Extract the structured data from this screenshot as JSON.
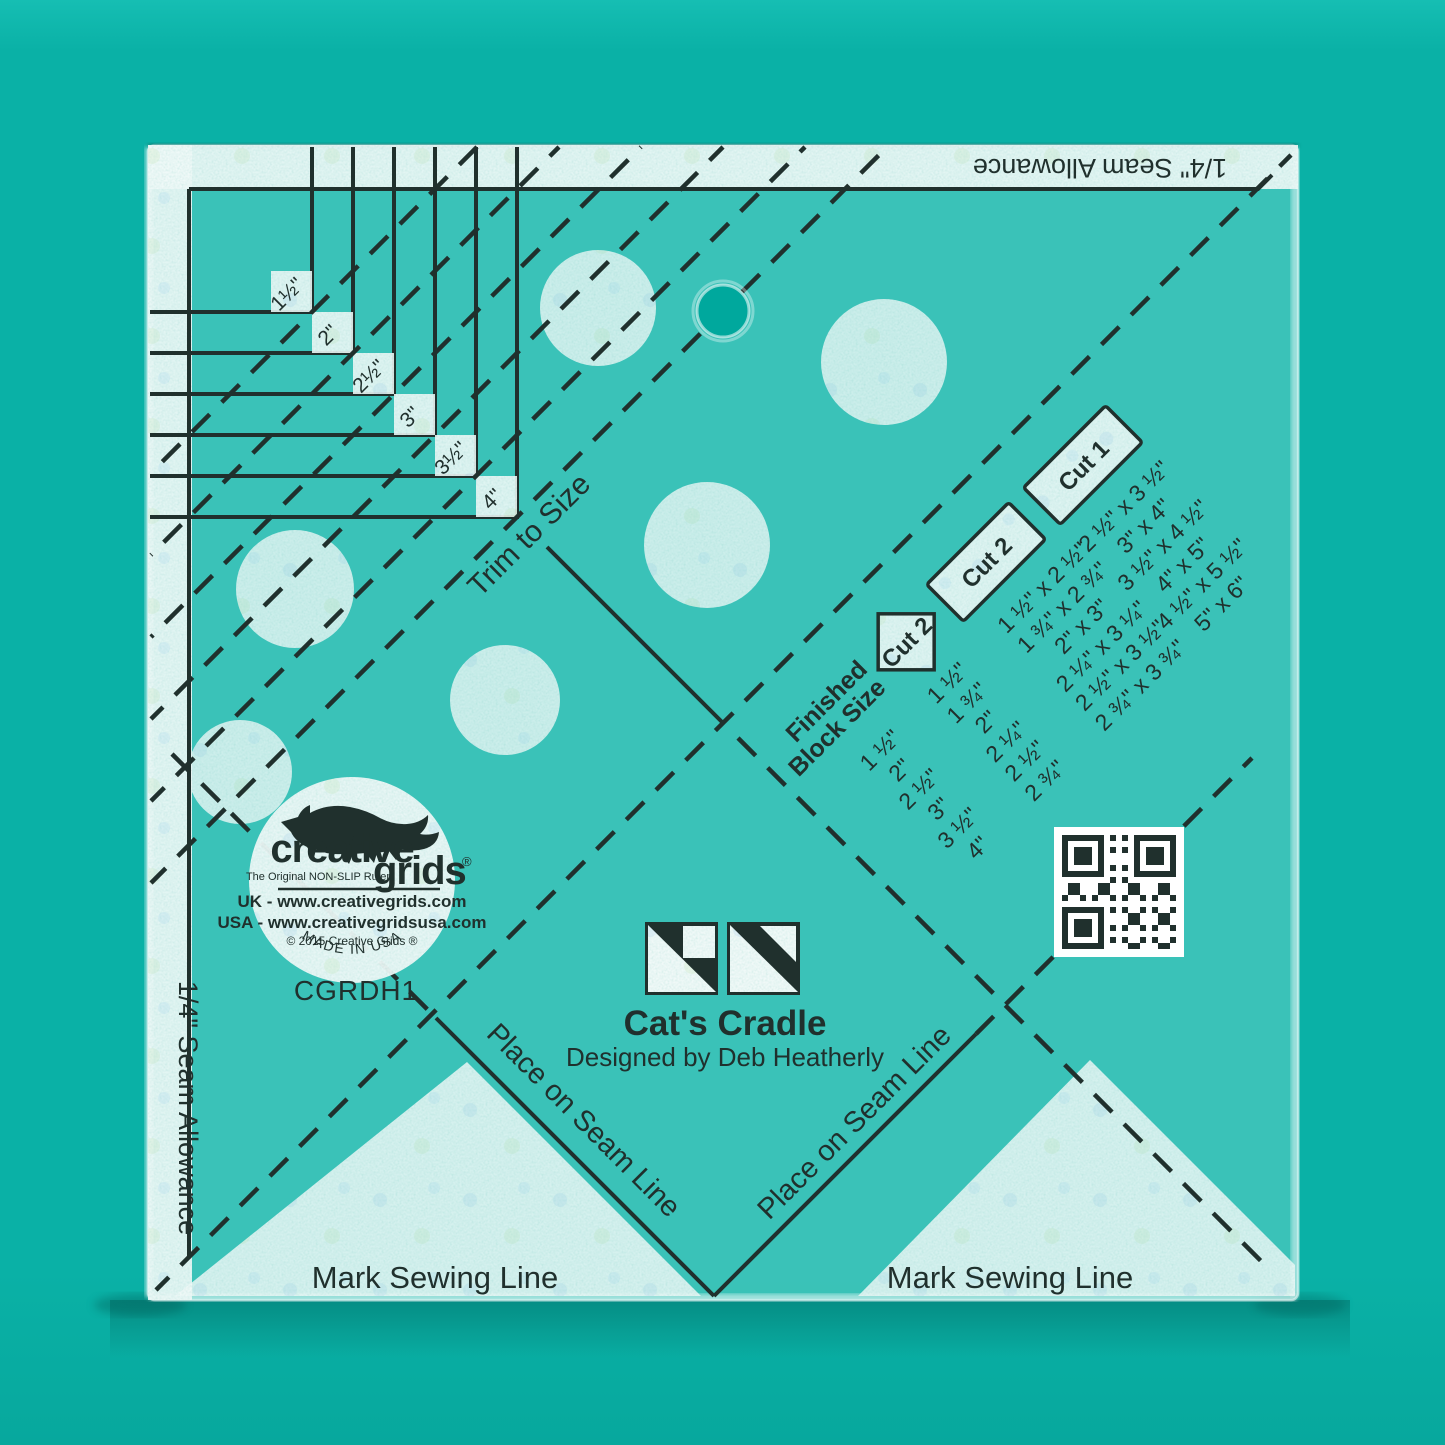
{
  "colors": {
    "background": "#0ab1a6",
    "background_top_band": "#16beb3",
    "ruler_tint": "#3cc4ba",
    "frost": "#c9e9e4",
    "ink": "#20302d",
    "shadow": "#00554f",
    "qr_white": "#ffffff"
  },
  "ruler": {
    "seam_allowance_top": "1/4\" Seam Allowance",
    "seam_allowance_left": "1/4\" Seam Allowance",
    "trim_label": "Trim to Size",
    "step_sizes": [
      "1½\"",
      "2\"",
      "2½\"",
      "3\"",
      "3½\"",
      "4\""
    ],
    "mark_sewing_left": "Mark Sewing Line",
    "mark_sewing_right": "Mark Sewing Line",
    "place_on_seam_left": "Place on Seam Line",
    "place_on_seam_right": "Place on Seam Line"
  },
  "table": {
    "row_header_line1": "Finished",
    "row_header_line2": "Block Size",
    "col_header_cut2_square": "Cut 2",
    "col_header_cut2_rect": "Cut 2",
    "col_header_cut1": "Cut 1",
    "rows": [
      {
        "finished": "1 ½\"",
        "cut2_square": "1 ½\"",
        "cut2_rect": "1 ½\" x 2 ½\"",
        "cut1": "2 ½\" x 3 ½\""
      },
      {
        "finished": "2\"",
        "cut2_square": "1 ¾\"",
        "cut2_rect": "1 ¾\" x 2 ¾\"",
        "cut1": "3\" x 4\""
      },
      {
        "finished": "2 ½\"",
        "cut2_square": "2\"",
        "cut2_rect": "2\" x 3\"",
        "cut1": "3 ½\" x 4 ½\""
      },
      {
        "finished": "3\"",
        "cut2_square": "2 ¼\"",
        "cut2_rect": "2 ¼\" x 3 ¼\"",
        "cut1": "4\" x 5\""
      },
      {
        "finished": "3 ½\"",
        "cut2_square": "2 ½\"",
        "cut2_rect": "2 ½\" x 3 ½\"",
        "cut1": "4 ½\" x 5 ½\""
      },
      {
        "finished": "4\"",
        "cut2_square": "2 ¾\"",
        "cut2_rect": "2 ¾\" x 3 ¾\"",
        "cut1": "5\" x 6\""
      }
    ]
  },
  "logo": {
    "brand_word1": "creative",
    "brand_word2": "grids",
    "registered": "®",
    "tagline": "The Original NON-SLIP Ruler",
    "uk_line": "UK - www.creativegrids.com",
    "usa_line": "USA - www.creativegridsusa.com",
    "copyright": "© 2015  Creative Grids ®",
    "made_in": "MADE IN USA"
  },
  "product": {
    "name": "Cat's Cradle",
    "designer": "Designed by Deb Heatherly",
    "sku": "CGRDH1"
  }
}
